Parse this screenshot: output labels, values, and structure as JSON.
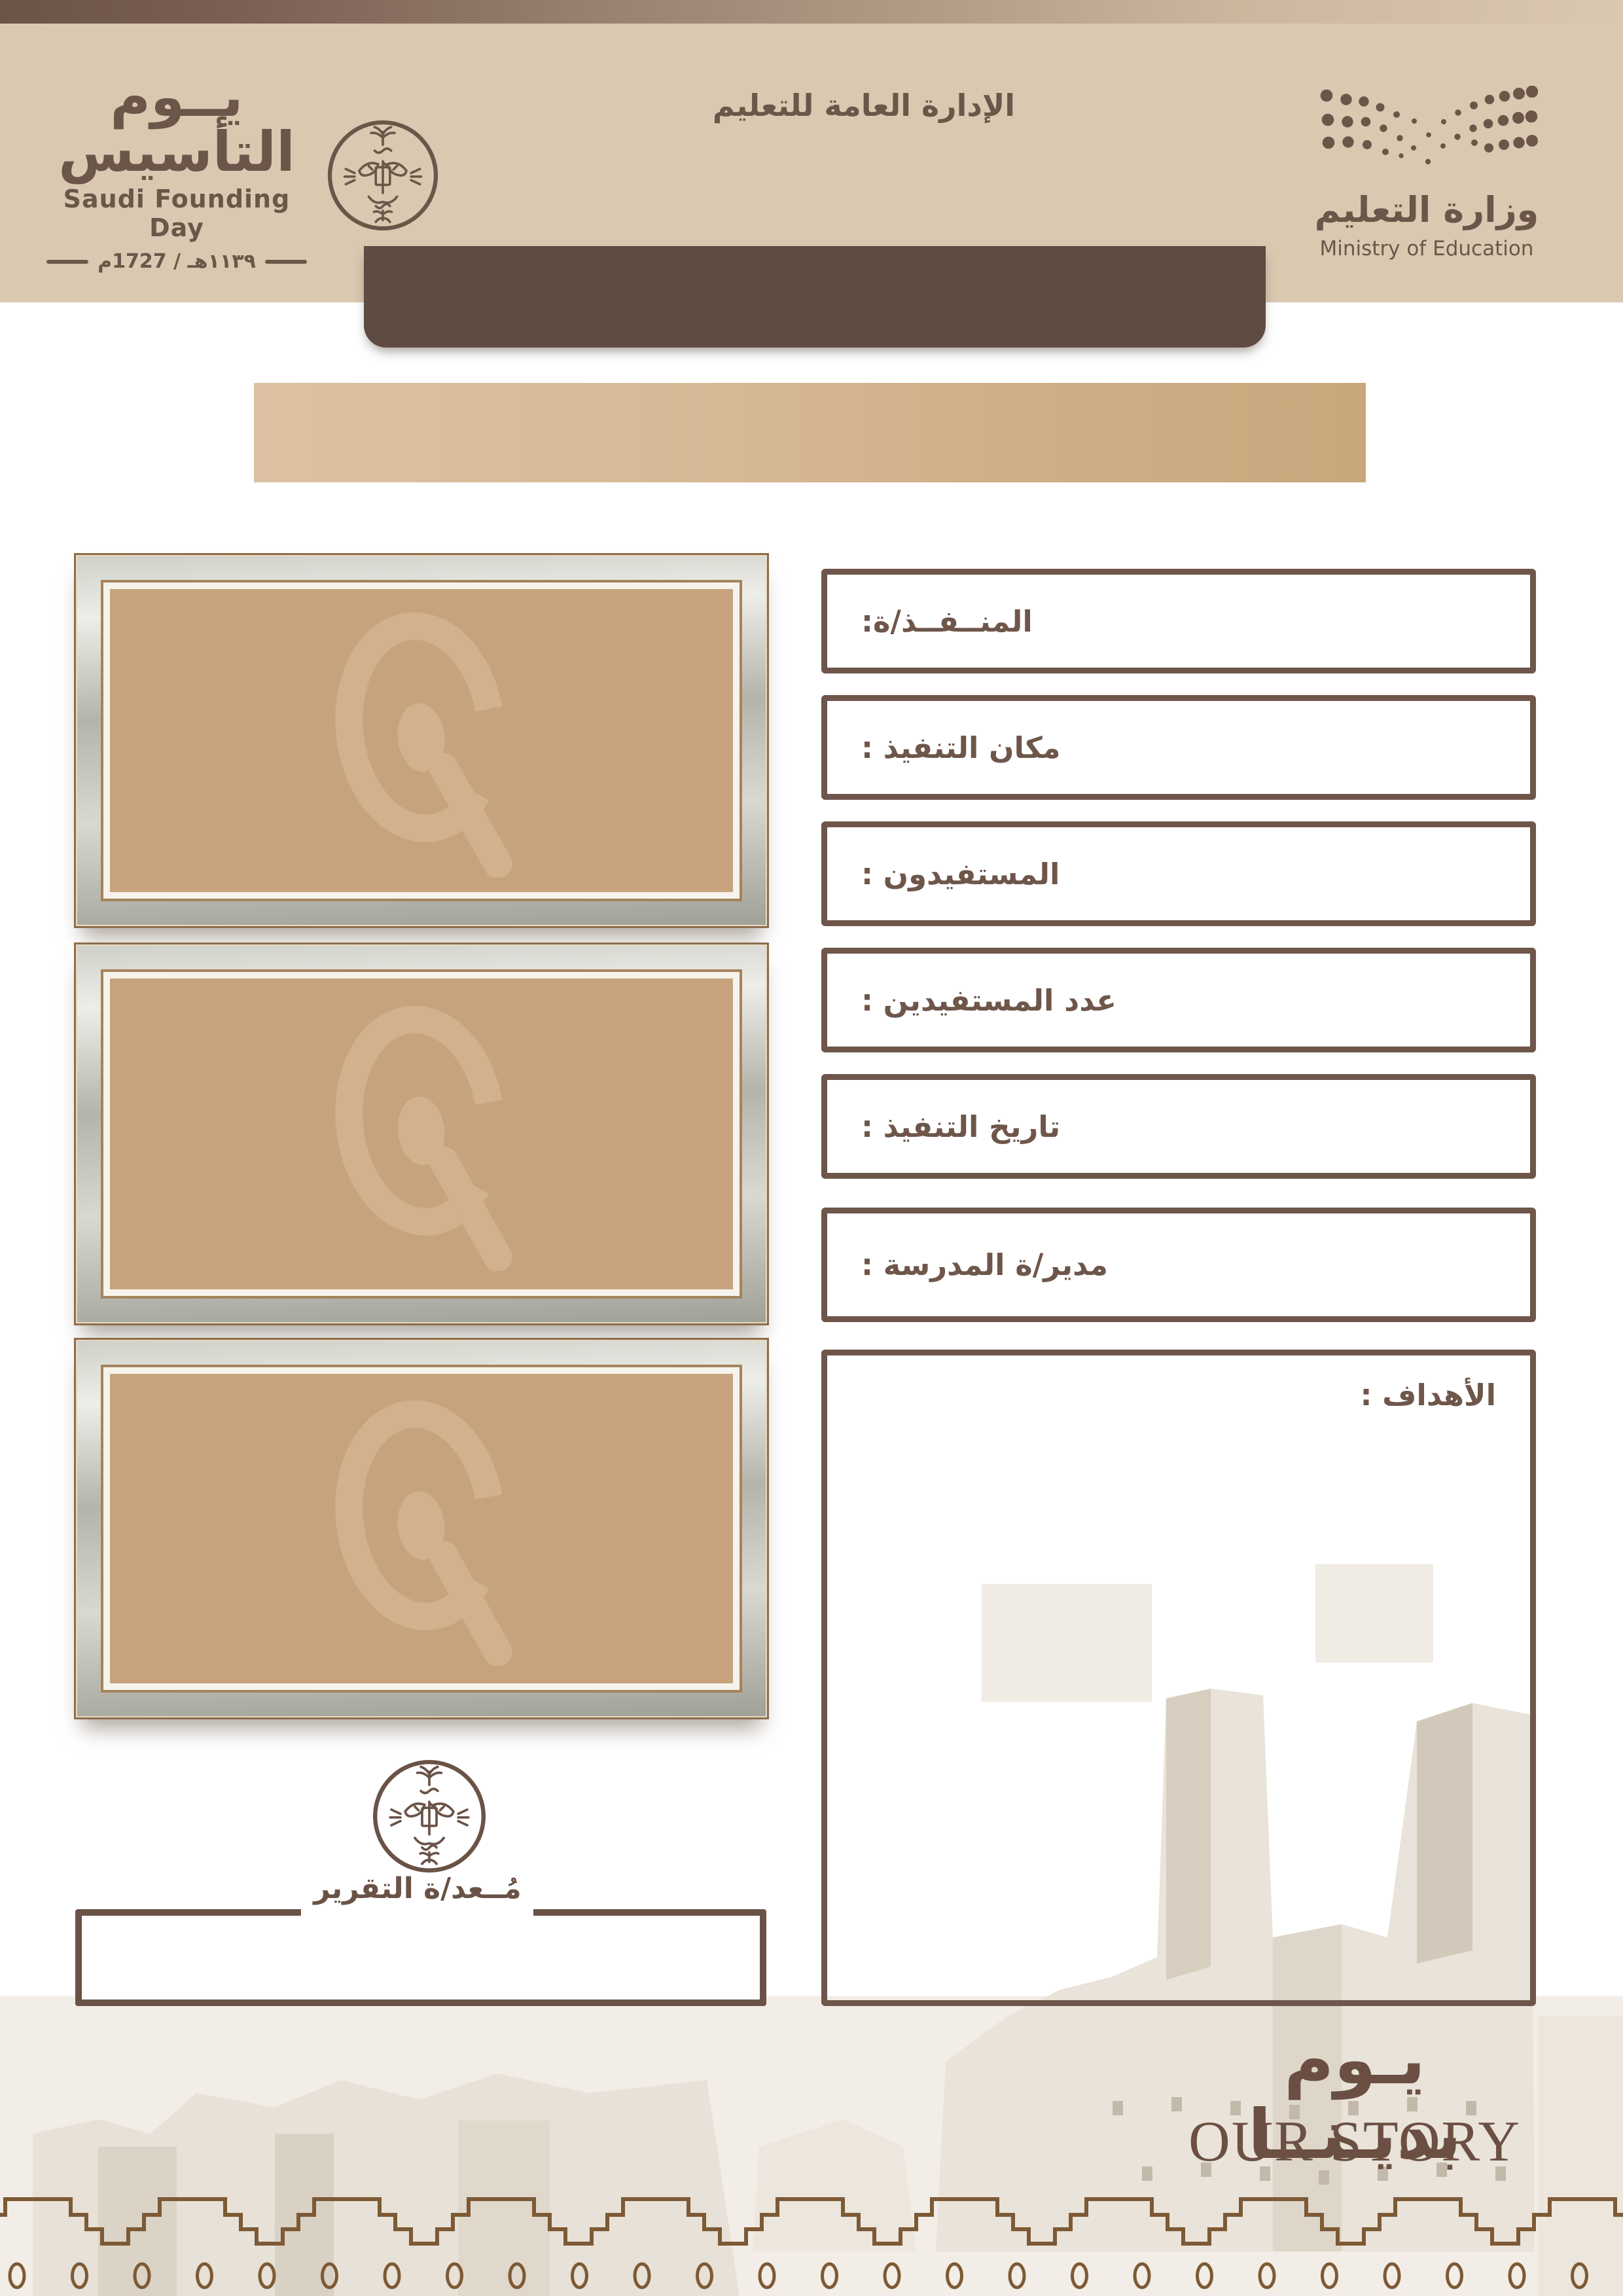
{
  "header": {
    "founding_day_logo": {
      "title_ar": "يــوم التأسيس",
      "title_en": "Saudi Founding Day",
      "date": "١١٣٩هـ / 1727م"
    },
    "department_title": "الإدارة العامة للتعليم",
    "ministry_logo": {
      "name_ar": "وزارة التعليم",
      "name_en": "Ministry of Education"
    }
  },
  "form": {
    "fields": [
      {
        "label": "المنــفــذ/ة:"
      },
      {
        "label": "مكان التنفيذ :"
      },
      {
        "label": "المستفيدون :"
      },
      {
        "label": "عدد المستفيدين :"
      },
      {
        "label": "تاريخ التنفيذ :"
      },
      {
        "label": "مدير/ة المدرسة :"
      }
    ],
    "objectives_label": "الأهداف :"
  },
  "report": {
    "preparer_label": "مُــعد/ة التقرير"
  },
  "slogan": {
    "ar": "يـوم بديـنــا",
    "en": "OUR STORY"
  },
  "colors": {
    "brand_brown": "#6b5649",
    "title_bar_brown": "#5e4b42",
    "header_beige": "#dbc8b1",
    "banner_tan_left": "#dcc2a2",
    "banner_tan_right": "#c9a77d",
    "frame_mat_tan": "#c7a37d",
    "border_brown": "#6e564a",
    "footer_pattern_brown": "#7d5a35",
    "slogan_brown": "#6b4f43"
  }
}
